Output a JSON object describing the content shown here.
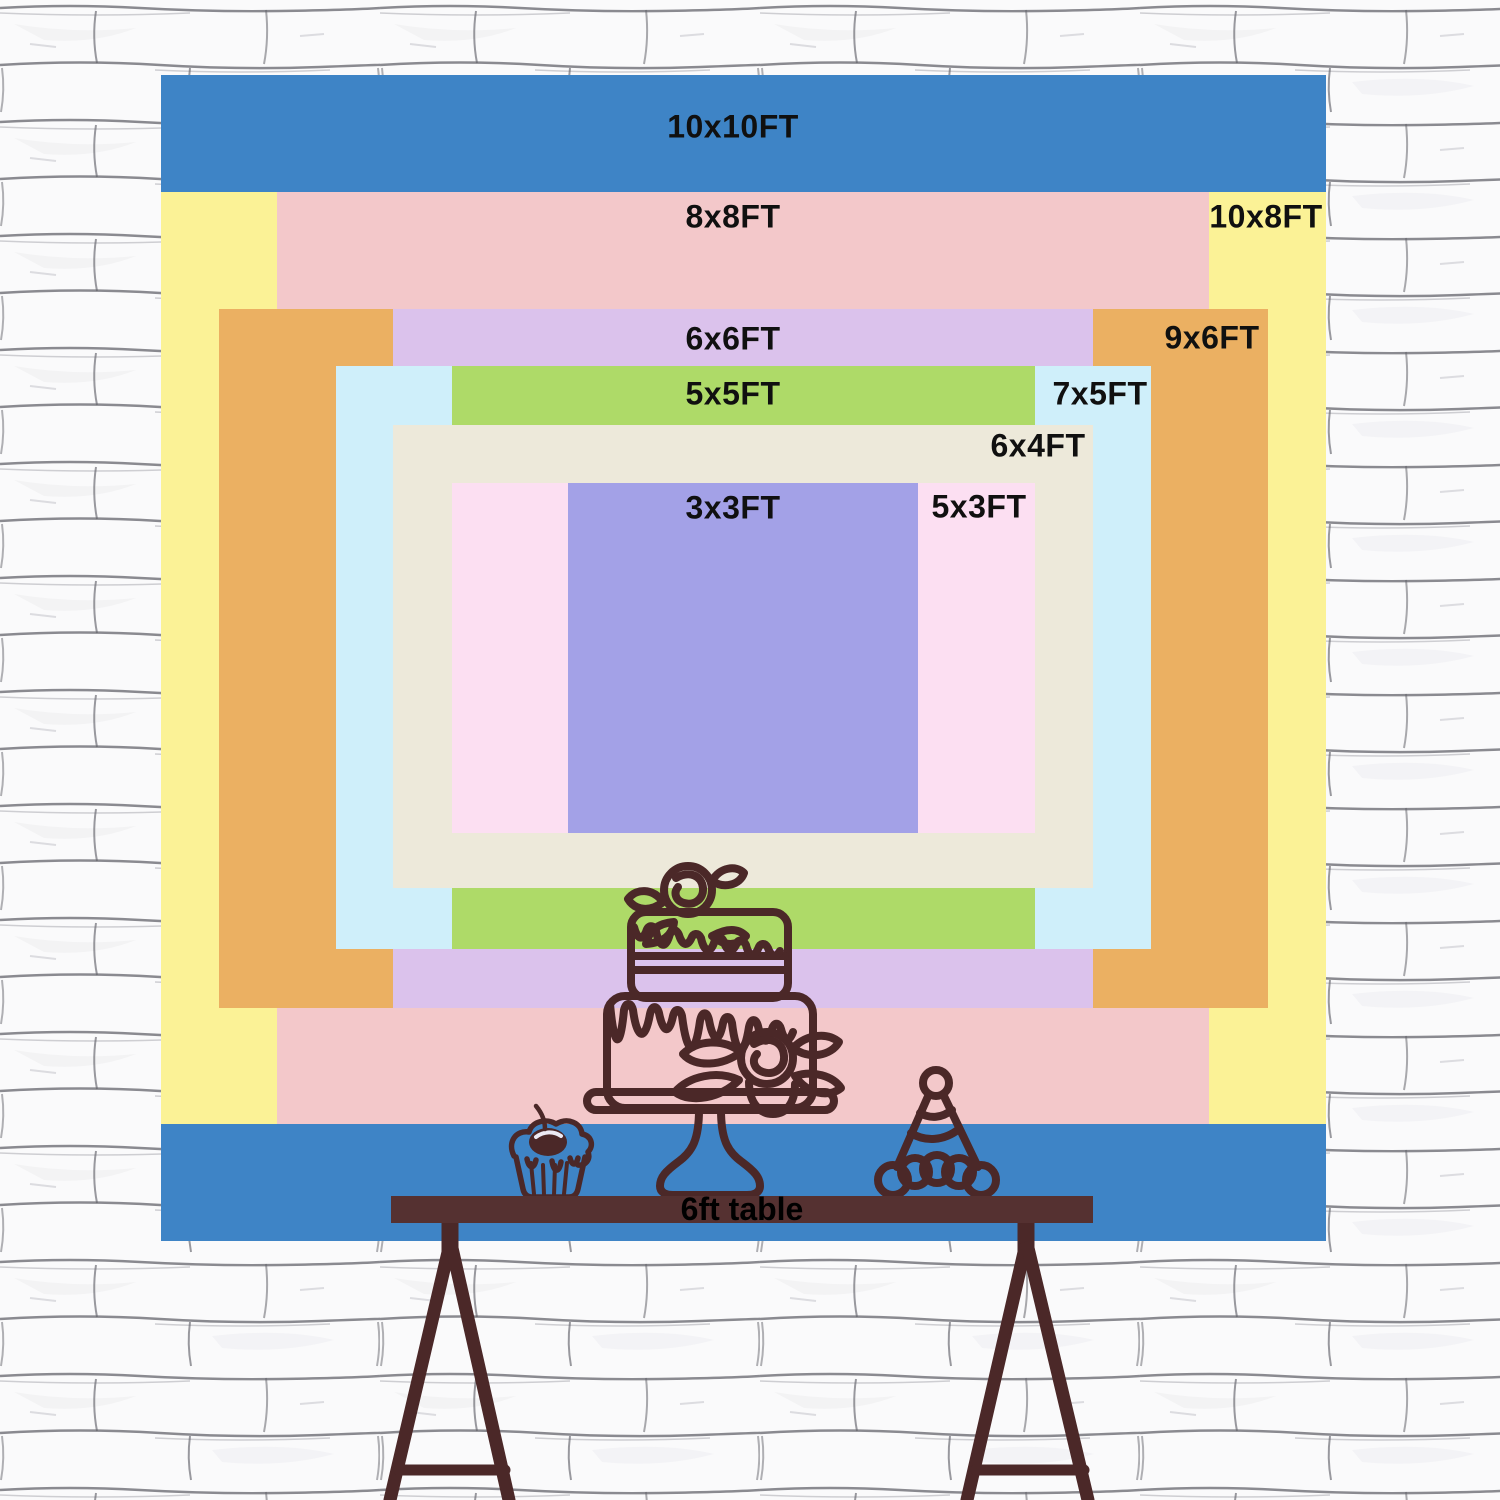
{
  "backdrop": {
    "description": "backdrop size comparison collage",
    "layers": [
      {
        "label": "10x10FT",
        "color": "#3e84c6"
      },
      {
        "label": "8x8FT",
        "color": "#f3c8ca"
      },
      {
        "label": "10x8FT",
        "color": "#fbf296"
      },
      {
        "label": "6x6FT",
        "color": "#dbc2ec"
      },
      {
        "label": "9x6FT",
        "color": "#ebb062"
      },
      {
        "label": "5x5FT",
        "color": "#aeda68"
      },
      {
        "label": "7x5FT",
        "color": "#cfeffa"
      },
      {
        "label": "6x4FT",
        "color": "#ede9da"
      },
      {
        "label": "3x3FT",
        "color": "#a3a1e7"
      },
      {
        "label": "5x3FT",
        "color": "#fcdff2"
      }
    ]
  },
  "table": {
    "label": "6ft table",
    "color": "#553131"
  },
  "decorations": {
    "line_color": "#4b2828",
    "cake": "two-tier-cake-line-art",
    "cupcake": "cupcake-with-cherry-line-art",
    "party_hat": "party-hat-line-art",
    "wall": "white-brick-wall"
  }
}
